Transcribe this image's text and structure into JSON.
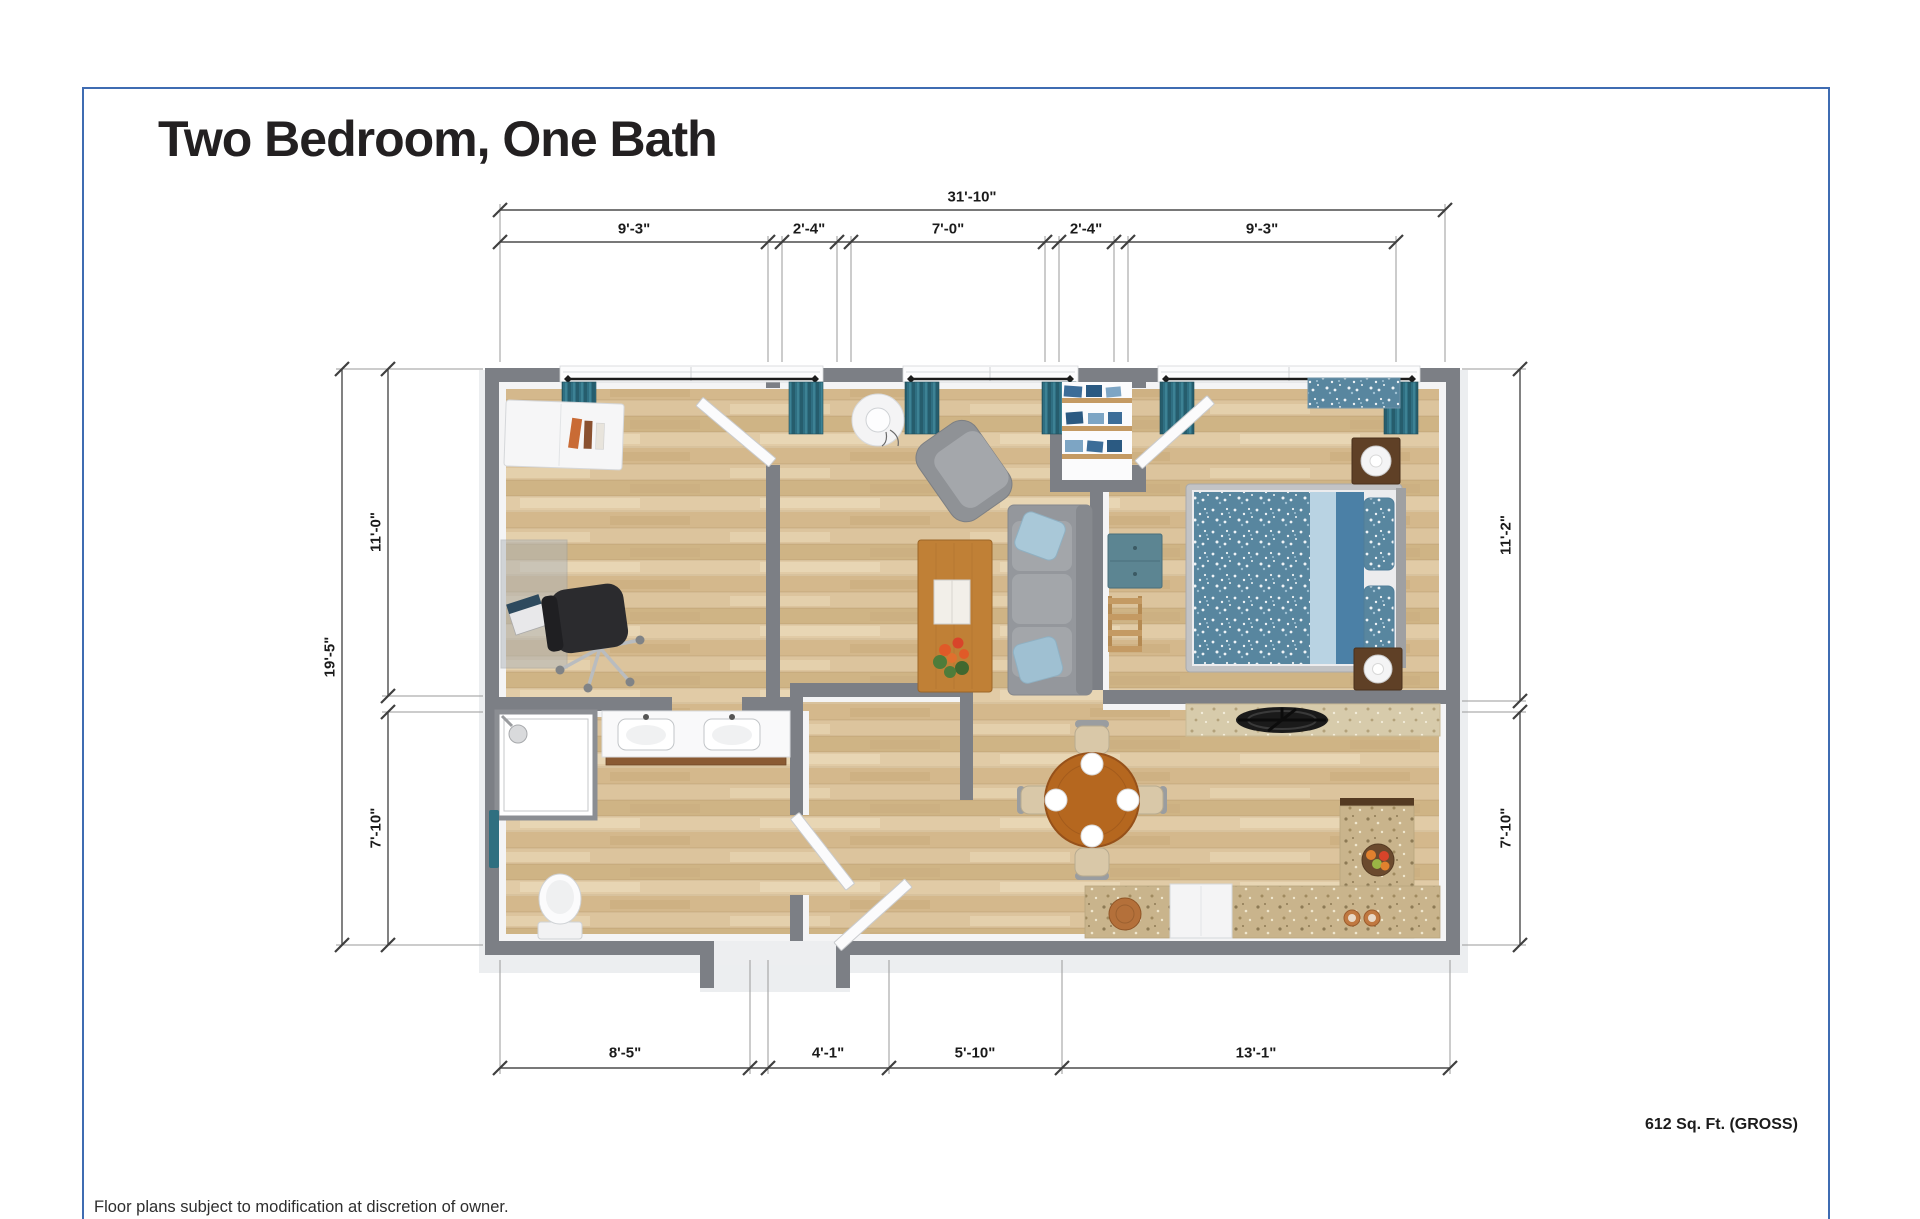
{
  "header": {
    "title": "Two Bedroom, One Bath"
  },
  "floor_plan": {
    "dimensions": {
      "top": {
        "total": "31'-10\"",
        "segments": [
          "9'-3\"",
          "2'-4\"",
          "7'-0\"",
          "2'-4\"",
          "9'-3\""
        ]
      },
      "left": {
        "total": "19'-5\"",
        "segments": [
          "11'-0\"",
          "7'-10\""
        ]
      },
      "right": {
        "segments": [
          "11'-2\"",
          "7'-10\""
        ]
      },
      "bottom": {
        "segments": [
          "8'-5\"",
          "4'-1\"",
          "5'-10\"",
          "13'-1\""
        ]
      }
    },
    "area": "612 Sq. Ft. (GROSS)"
  },
  "footer": {
    "disclaimer": "Floor plans subject to modification at discretion of owner."
  },
  "colors": {
    "border_blue": "#3f6cb2",
    "wall_gray": "#7c7f85",
    "floor_wood": "#d8bf97",
    "curtain_teal": "#2f6f82",
    "bed_blue": "#58869f",
    "counter_granite": "#c9b48c",
    "table_wood": "#b5671f"
  }
}
